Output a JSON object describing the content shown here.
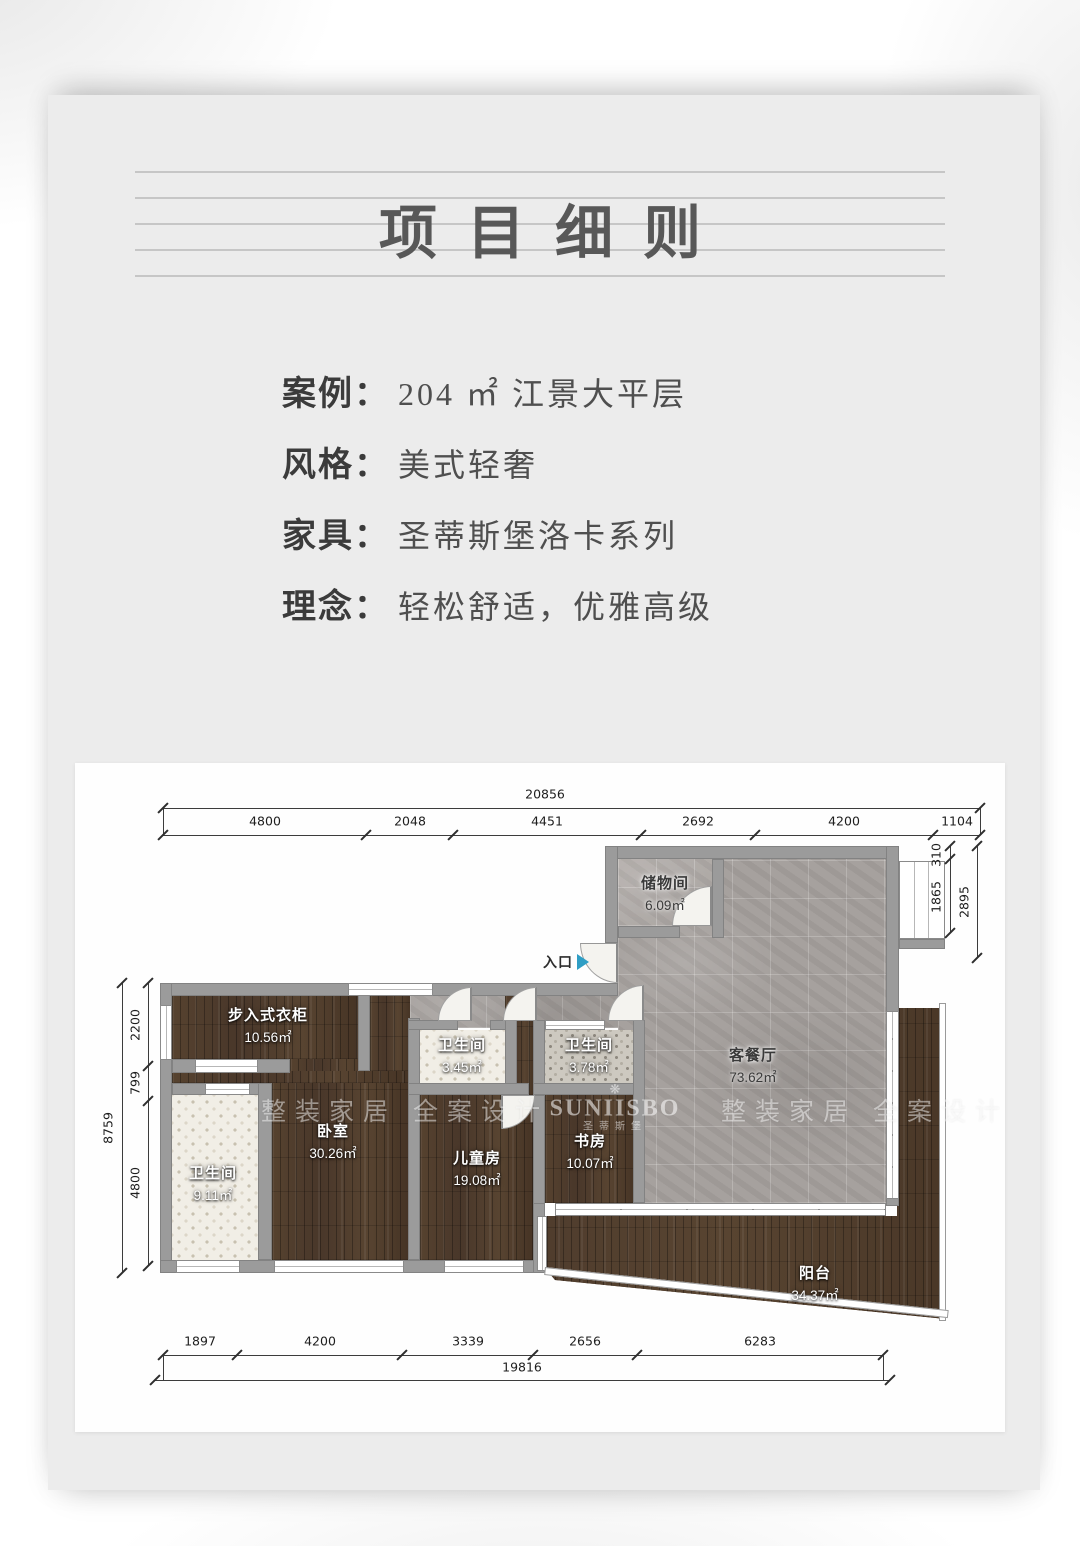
{
  "header": {
    "title": "项目细则"
  },
  "info": {
    "separator": "：",
    "rows": [
      {
        "label": "案例",
        "value": "204 ㎡ 江景大平层"
      },
      {
        "label": "风格",
        "value": "美式轻奢"
      },
      {
        "label": "家具",
        "value": "圣蒂斯堡洛卡系列"
      },
      {
        "label": "理念",
        "value": "轻松舒适，优雅高级"
      }
    ]
  },
  "floorplan": {
    "entrance": {
      "label": "入口"
    },
    "watermark": {
      "slogan": "整装家居 全案设计",
      "brand": "SUNIISBO",
      "brand_cn": "圣蒂斯堡",
      "flower": "❋"
    },
    "rooms": [
      {
        "name": "储物间",
        "area": "6.09㎡"
      },
      {
        "name": "客餐厅",
        "area": "73.62㎡"
      },
      {
        "name": "步入式衣柜",
        "area": "10.56㎡"
      },
      {
        "name": "卫生间",
        "area": "3.45㎡"
      },
      {
        "name": "卫生间",
        "area": "3.78㎡"
      },
      {
        "name": "卧室",
        "area": "30.26㎡"
      },
      {
        "name": "儿童房",
        "area": "19.08㎡"
      },
      {
        "name": "书房",
        "area": "10.07㎡"
      },
      {
        "name": "卫生间",
        "area": "9.11㎡"
      },
      {
        "name": "阳台",
        "area": "34.37㎡"
      }
    ],
    "dimensions": {
      "top": {
        "total": "20856",
        "segments": [
          "4800",
          "2048",
          "4451",
          "2692",
          "4200",
          "1104"
        ]
      },
      "bottom": {
        "total": "19816",
        "segments": [
          "1897",
          "4200",
          "3339",
          "2656",
          "6283"
        ]
      },
      "left": {
        "total": "8759",
        "segments": [
          "2200",
          "799",
          "4800"
        ]
      },
      "right": {
        "outer": "2895",
        "segments": [
          "310",
          "1865"
        ]
      }
    },
    "colors": {
      "wood": "#4d3a2a",
      "stone_tile": "#a6a19e",
      "wall": "#9b9b9b",
      "entry_arrow": "#2f9ec5"
    }
  }
}
